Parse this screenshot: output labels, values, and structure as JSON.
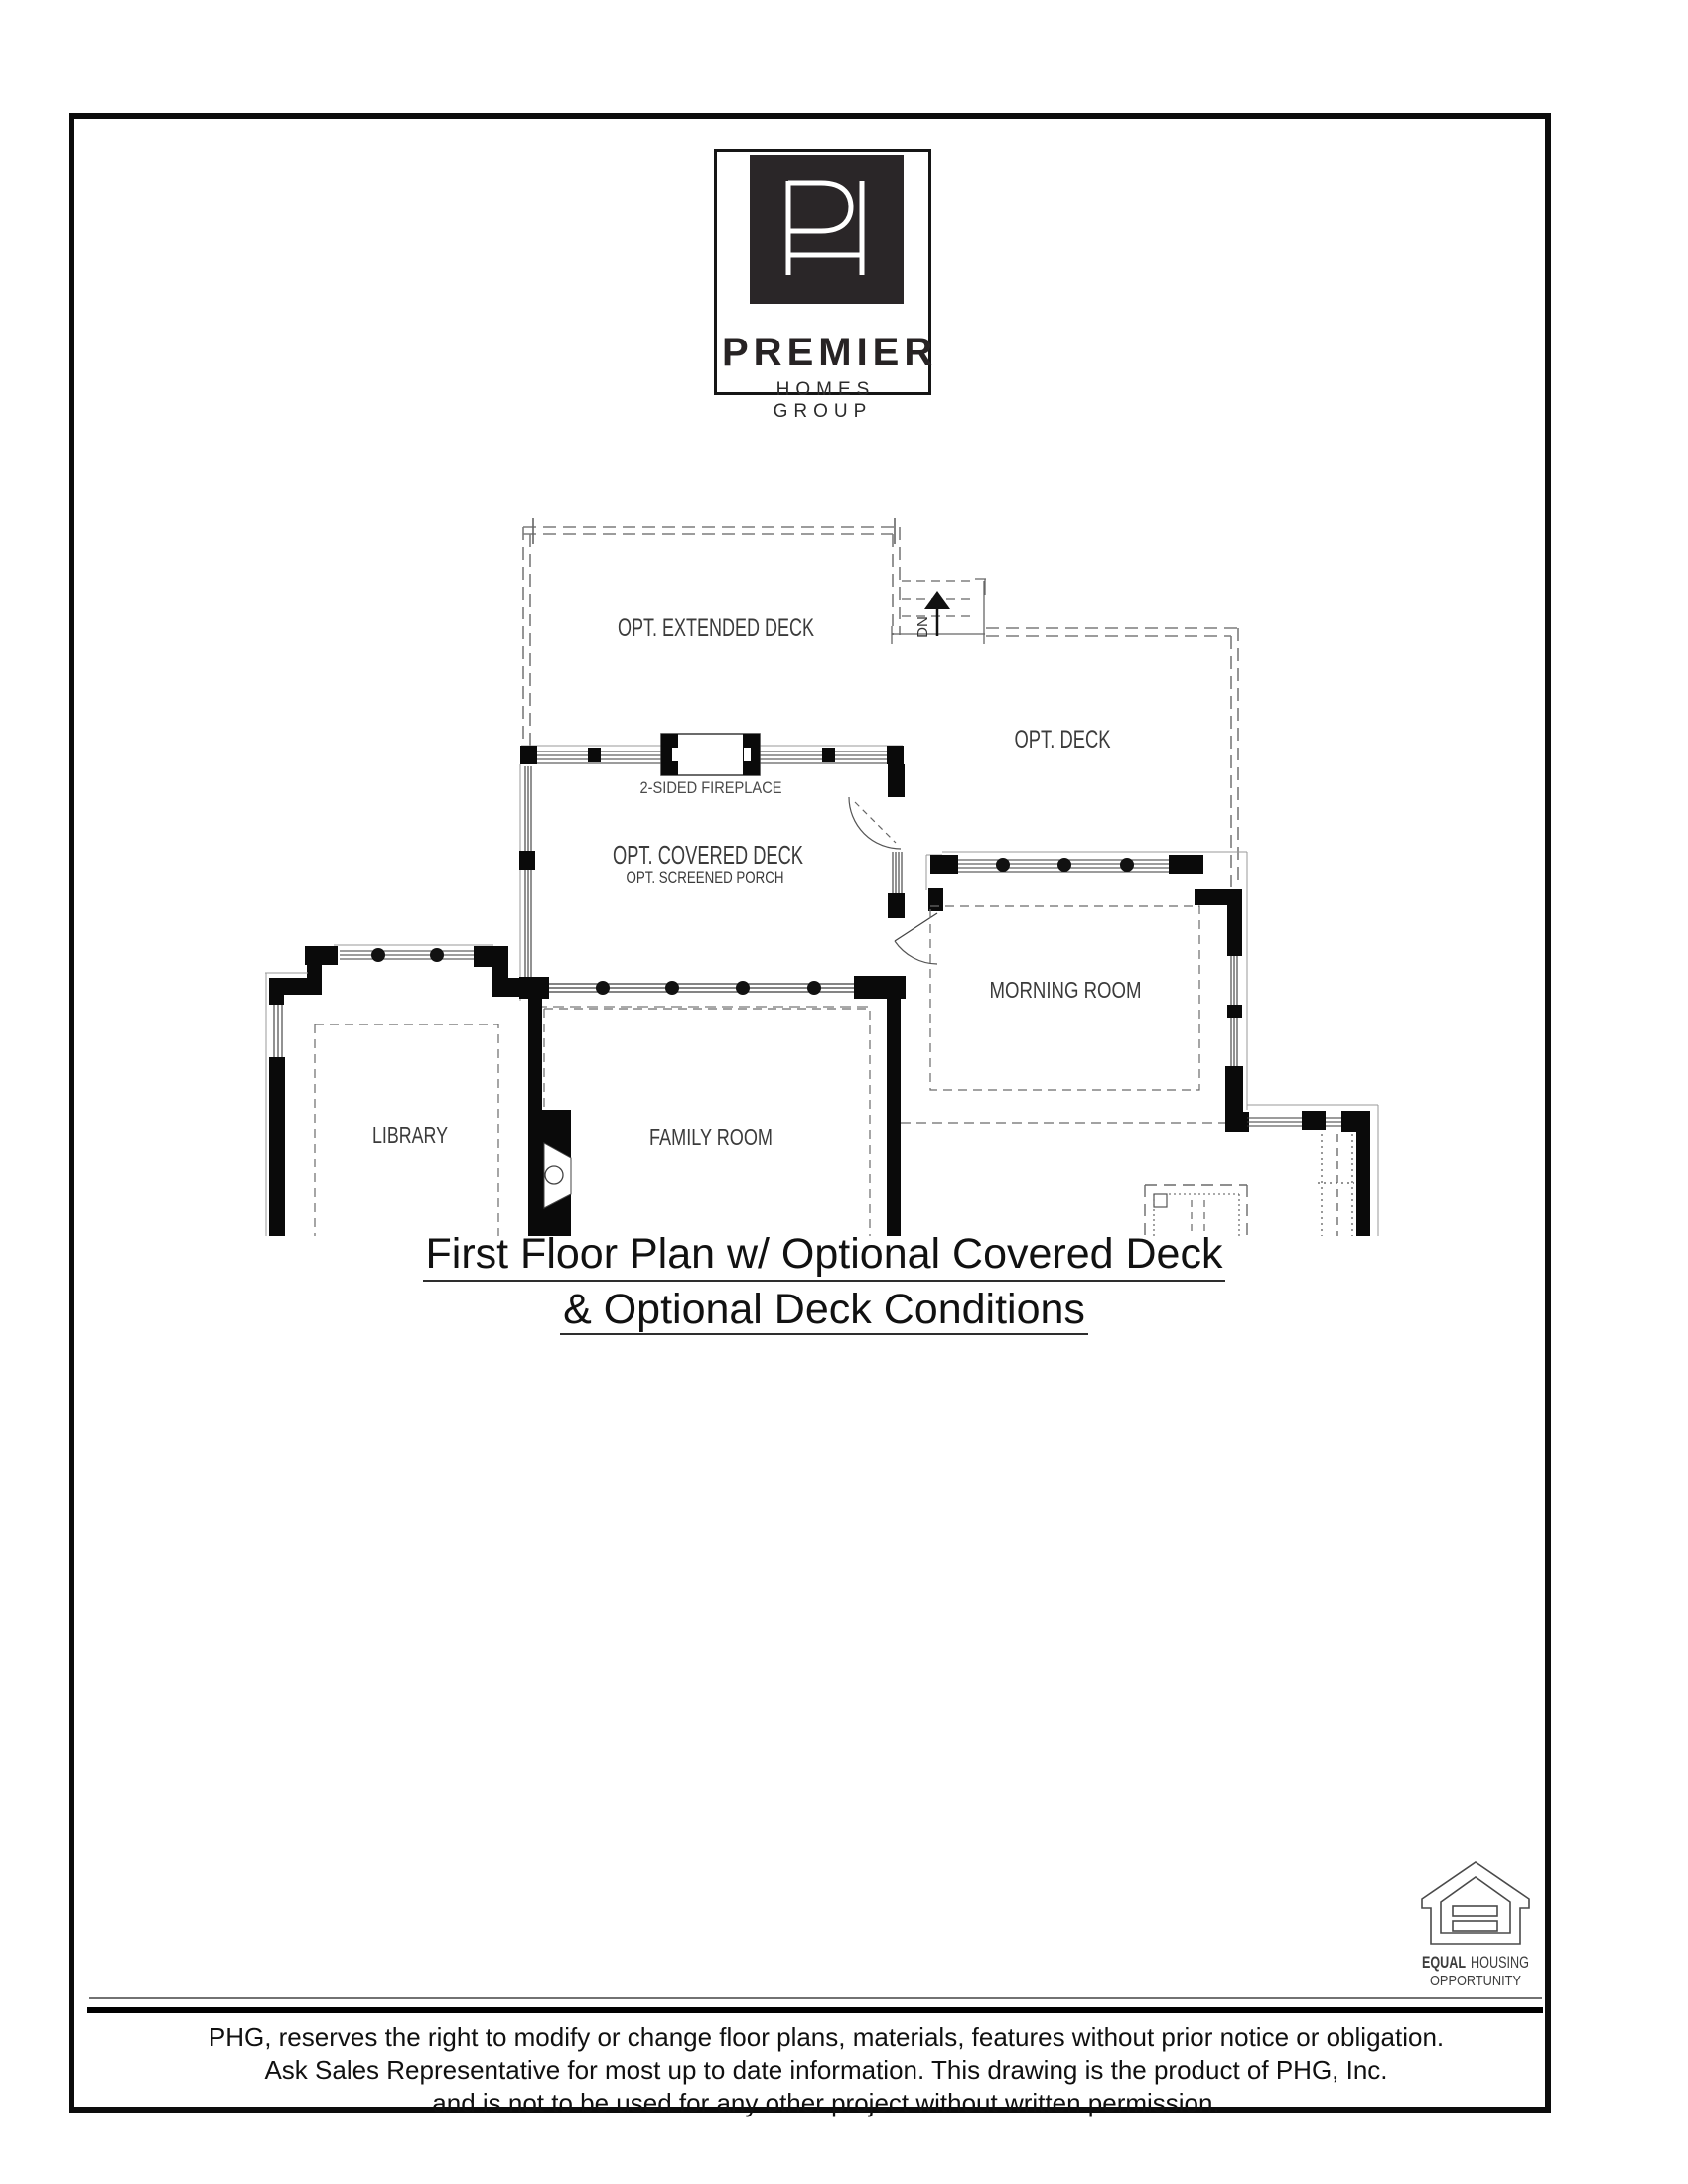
{
  "logo": {
    "name": "PREMIER",
    "tagline": "HOMES GROUP"
  },
  "plan_labels": {
    "extended_deck": "OPT. EXTENDED DECK",
    "deck": "OPT. DECK",
    "covered_deck": "OPT. COVERED DECK",
    "screened_porch": "OPT. SCREENED PORCH",
    "fireplace": "2-SIDED FIREPLACE",
    "morning_room": "MORNING ROOM",
    "family_room": "FAMILY ROOM",
    "library": "LIBRARY",
    "stair_down": "DN"
  },
  "title": {
    "line1": "First Floor Plan w/ Optional Covered Deck",
    "line2": "& Optional Deck Conditions"
  },
  "equal_housing": {
    "word_equal": "EQUAL",
    "word_housing": "HOUSING",
    "word_opportunity": "OPPORTUNITY"
  },
  "disclaimer": {
    "line1": "PHG, reserves the right to modify or change floor plans, materials, features without prior notice or obligation.",
    "line2": "Ask Sales Representative for most up to date information. This drawing is the product of PHG, Inc.",
    "line3": "and is not to be used for any other project without written permission."
  },
  "colors": {
    "ink": "#101010",
    "wall": "#0a0a0a",
    "line_gray": "#6e6e6e",
    "logo_square": "#2a2628"
  }
}
